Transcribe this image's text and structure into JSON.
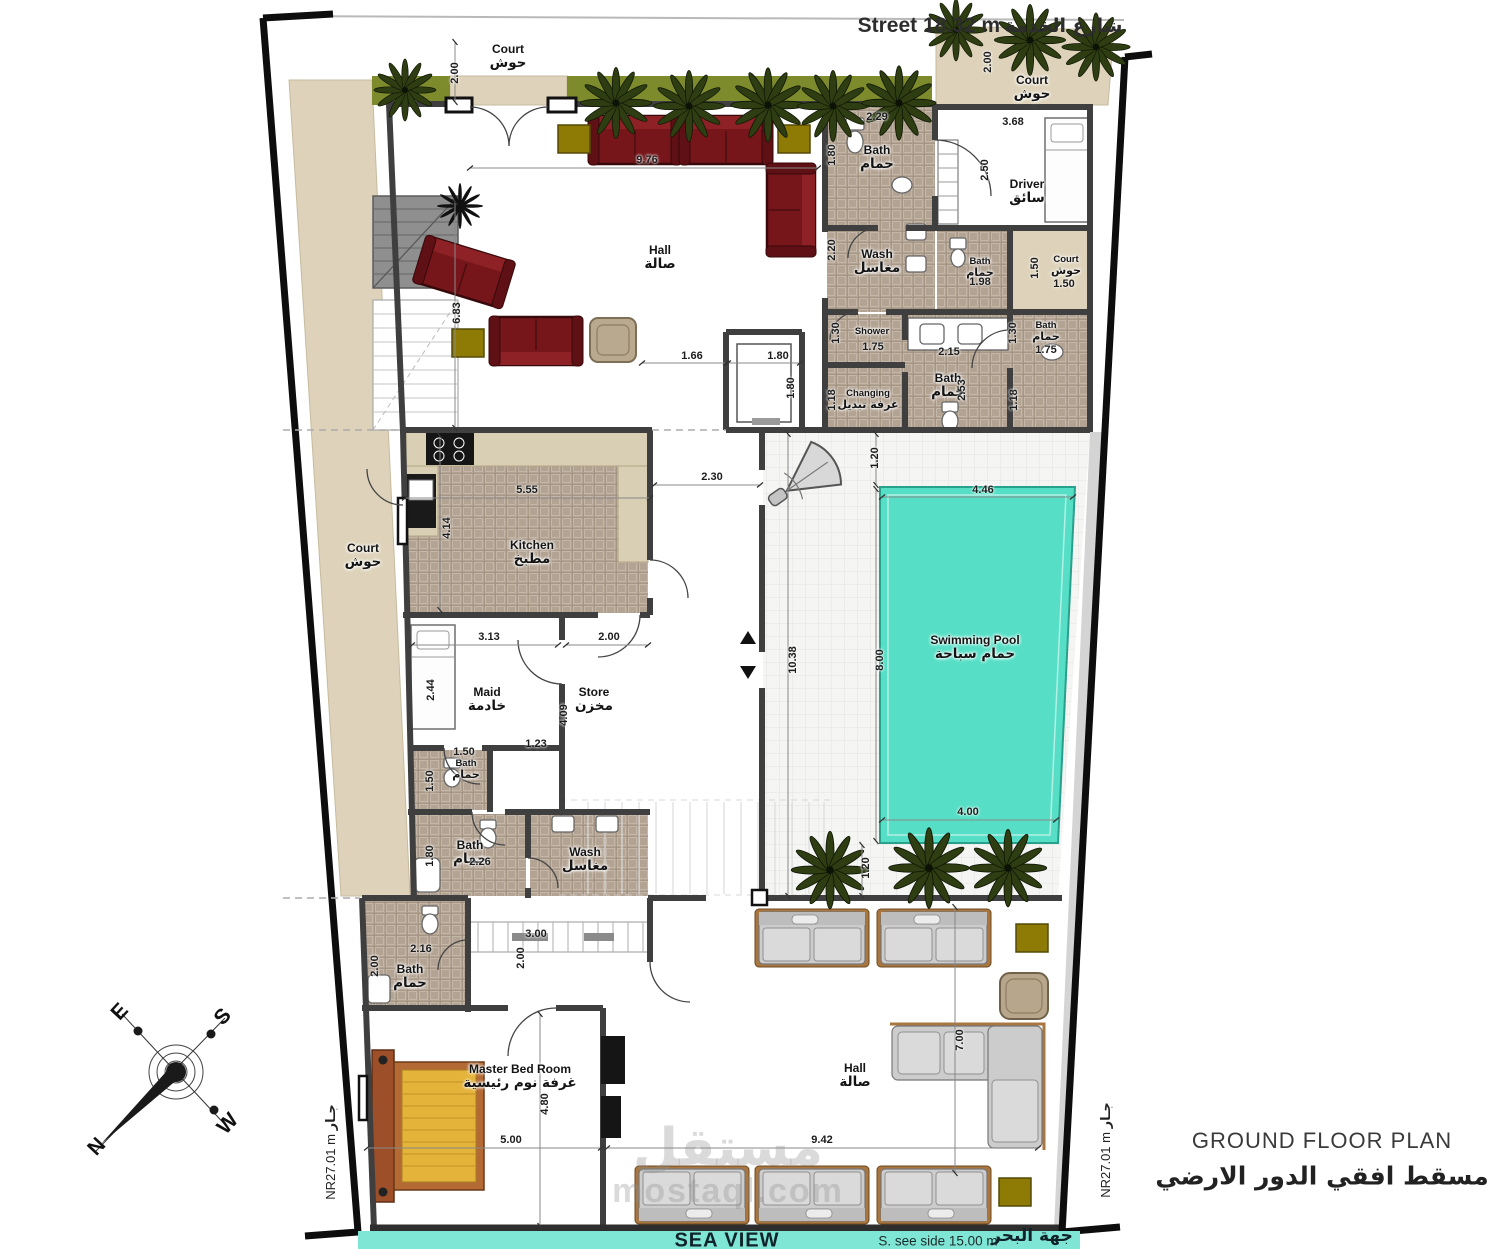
{
  "title": {
    "en": "GROUND FLOOR PLAN",
    "ar": "مسقط افقي الدور الارضي"
  },
  "street": {
    "en": "Street 18.32 m",
    "ar": "شارع الخدمة"
  },
  "sea": {
    "label": "SEA VIEW",
    "side": "S. see side 15.00 m",
    "ar": "جهة البحر"
  },
  "nr_left": {
    "value": "NR27.01 m",
    "ar": "جـار"
  },
  "nr_right": {
    "value": "NR27.01 m",
    "ar": "جـار"
  },
  "compass": {
    "n": "N",
    "e": "E",
    "s": "S",
    "w": "W"
  },
  "watermark": {
    "logo": "مستقل",
    "url": "mostaql.com"
  },
  "colors": {
    "pool": "#56dfc6",
    "grass": "#7d8b2d",
    "court": "#ded3ba",
    "tile": "#b3a392",
    "wall": "#3f3f3f",
    "sofa_red": "#77161a",
    "sofa_gray": "#cccccc",
    "gold": "#8d7b06",
    "sea_strip": "#7fe6d5",
    "bed": "#e4b33a"
  },
  "rooms": [
    {
      "en": "Court",
      "ar": "حوش",
      "x": 508,
      "y": 57
    },
    {
      "en": "Court",
      "ar": "حوش",
      "x": 1032,
      "y": 88
    },
    {
      "en": "Hall",
      "ar": "صالة",
      "x": 660,
      "y": 258
    },
    {
      "en": "Bath",
      "ar": "حمام",
      "x": 877,
      "y": 158
    },
    {
      "en": "Driver",
      "ar": "سائق",
      "x": 1027,
      "y": 192
    },
    {
      "en": "Wash",
      "ar": "مغاسل",
      "x": 877,
      "y": 262
    },
    {
      "en": "Bath",
      "ar": "حمام",
      "x": 980,
      "y": 268,
      "s": 1
    },
    {
      "en": "Court",
      "ar": "حوش",
      "x": 1066,
      "y": 266,
      "s": 1
    },
    {
      "en": "Shower",
      "ar": "",
      "x": 872,
      "y": 332,
      "s": 1
    },
    {
      "en": "Bath",
      "ar": "حمام",
      "x": 1046,
      "y": 332,
      "s": 1
    },
    {
      "en": "Bath",
      "ar": "حمام",
      "x": 948,
      "y": 386
    },
    {
      "en": "Changing",
      "ar": "غرفة تبديل",
      "x": 868,
      "y": 400,
      "s": 1
    },
    {
      "en": "Court",
      "ar": "حوش",
      "x": 363,
      "y": 556
    },
    {
      "en": "Kitchen",
      "ar": "مطبخ",
      "x": 532,
      "y": 553
    },
    {
      "en": "Maid",
      "ar": "خادمة",
      "x": 487,
      "y": 700
    },
    {
      "en": "Store",
      "ar": "مخزن",
      "x": 594,
      "y": 700
    },
    {
      "en": "Bath",
      "ar": "حمام",
      "x": 466,
      "y": 770,
      "s": 1
    },
    {
      "en": "Bath",
      "ar": "حمام",
      "x": 470,
      "y": 853
    },
    {
      "en": "Wash",
      "ar": "مغاسل",
      "x": 585,
      "y": 860
    },
    {
      "en": "Bath",
      "ar": "حمام",
      "x": 410,
      "y": 977
    },
    {
      "en": "Swimming Pool",
      "ar": "حمام سباحة",
      "x": 975,
      "y": 648
    },
    {
      "en": "Master Bed Room",
      "ar": "غرفة نوم رئيسية",
      "x": 520,
      "y": 1077
    },
    {
      "en": "Hall",
      "ar": "صالة",
      "x": 855,
      "y": 1076
    }
  ],
  "dims": [
    {
      "t": "2.00",
      "x": 455,
      "y": 73,
      "v": 1
    },
    {
      "t": "9.76",
      "x": 647,
      "y": 160
    },
    {
      "t": "2.29",
      "x": 877,
      "y": 117
    },
    {
      "t": "1.80",
      "x": 832,
      "y": 155,
      "v": 1
    },
    {
      "t": "3.68",
      "x": 1013,
      "y": 122
    },
    {
      "t": "2.50",
      "x": 985,
      "y": 170,
      "v": 1
    },
    {
      "t": "2.00",
      "x": 988,
      "y": 62,
      "v": 1
    },
    {
      "t": "2.20",
      "x": 832,
      "y": 250,
      "v": 1
    },
    {
      "t": "1.50",
      "x": 1035,
      "y": 268,
      "v": 1
    },
    {
      "t": "1.98",
      "x": 980,
      "y": 282
    },
    {
      "t": "1.50",
      "x": 1064,
      "y": 284
    },
    {
      "t": "6.83",
      "x": 457,
      "y": 313,
      "v": 1
    },
    {
      "t": "1.66",
      "x": 692,
      "y": 356
    },
    {
      "t": "1.80",
      "x": 778,
      "y": 356
    },
    {
      "t": "1.80",
      "x": 791,
      "y": 388,
      "v": 1
    },
    {
      "t": "1.30",
      "x": 836,
      "y": 333,
      "v": 1
    },
    {
      "t": "1.75",
      "x": 873,
      "y": 347
    },
    {
      "t": "2.15",
      "x": 949,
      "y": 352
    },
    {
      "t": "1.30",
      "x": 1013,
      "y": 333,
      "v": 1
    },
    {
      "t": "1.75",
      "x": 1046,
      "y": 350
    },
    {
      "t": "1.18",
      "x": 832,
      "y": 400,
      "v": 1
    },
    {
      "t": "2.53",
      "x": 962,
      "y": 390,
      "v": 1
    },
    {
      "t": "1.18",
      "x": 1014,
      "y": 400,
      "v": 1
    },
    {
      "t": "2.30",
      "x": 712,
      "y": 477
    },
    {
      "t": "1.20",
      "x": 875,
      "y": 458,
      "v": 1
    },
    {
      "t": "4.46",
      "x": 983,
      "y": 490
    },
    {
      "t": "5.55",
      "x": 527,
      "y": 490
    },
    {
      "t": "4.14",
      "x": 447,
      "y": 528,
      "v": 1
    },
    {
      "t": "10.38",
      "x": 793,
      "y": 660,
      "v": 1
    },
    {
      "t": "8.00",
      "x": 880,
      "y": 660,
      "v": 1
    },
    {
      "t": "3.13",
      "x": 489,
      "y": 637
    },
    {
      "t": "2.00",
      "x": 609,
      "y": 637
    },
    {
      "t": "2.44",
      "x": 431,
      "y": 690,
      "v": 1
    },
    {
      "t": "4.09",
      "x": 564,
      "y": 715,
      "v": 1
    },
    {
      "t": "1.23",
      "x": 536,
      "y": 744
    },
    {
      "t": "1.50",
      "x": 464,
      "y": 752
    },
    {
      "t": "1.50",
      "x": 430,
      "y": 781,
      "v": 1
    },
    {
      "t": "1.80",
      "x": 430,
      "y": 856,
      "v": 1
    },
    {
      "t": "2.26",
      "x": 480,
      "y": 862
    },
    {
      "t": "2.16",
      "x": 421,
      "y": 949
    },
    {
      "t": "2.00",
      "x": 375,
      "y": 966,
      "v": 1
    },
    {
      "t": "3.00",
      "x": 536,
      "y": 934
    },
    {
      "t": "2.00",
      "x": 521,
      "y": 958,
      "v": 1
    },
    {
      "t": "4.00",
      "x": 968,
      "y": 812
    },
    {
      "t": "1.20",
      "x": 866,
      "y": 868,
      "v": 1
    },
    {
      "t": "9.42",
      "x": 822,
      "y": 1140
    },
    {
      "t": "7.00",
      "x": 960,
      "y": 1040,
      "v": 1
    },
    {
      "t": "4.80",
      "x": 545,
      "y": 1104,
      "v": 1
    },
    {
      "t": "5.00",
      "x": 511,
      "y": 1140
    }
  ]
}
